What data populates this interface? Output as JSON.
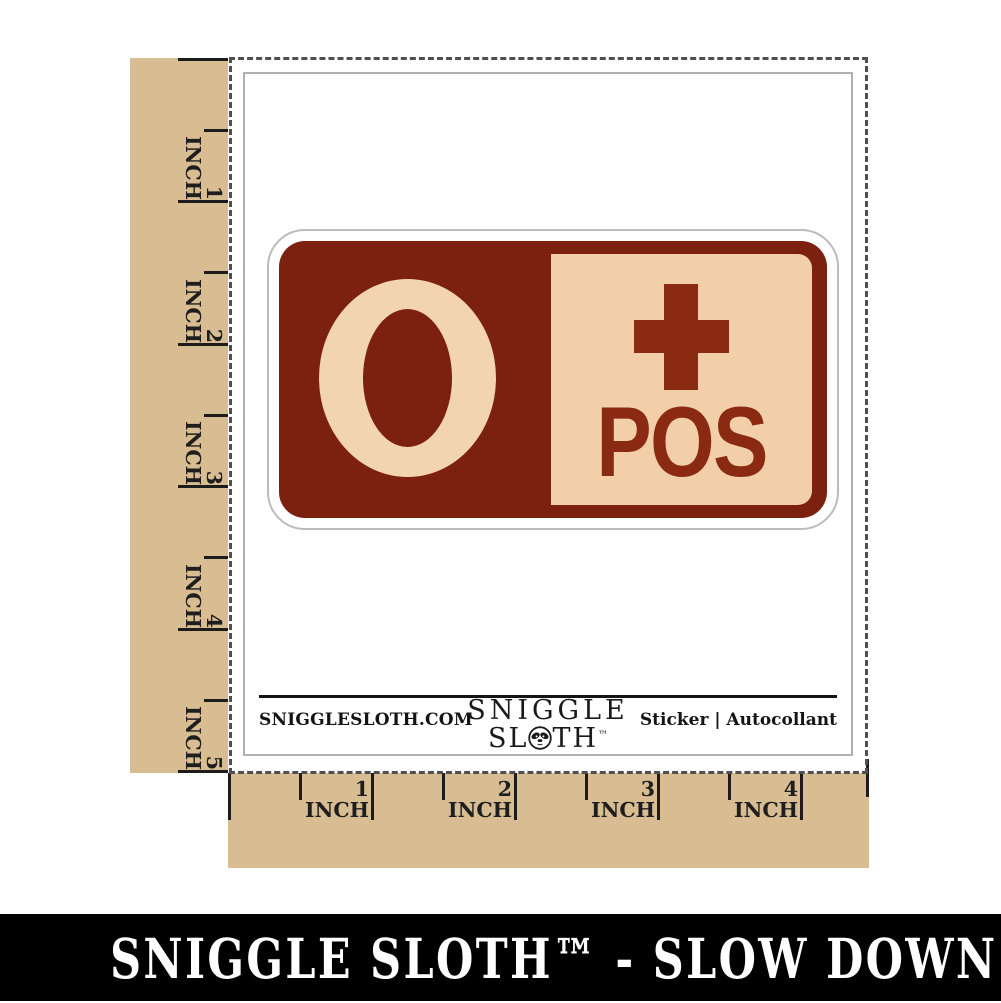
{
  "rulers": {
    "unit": "INCH",
    "vertical_labels": [
      "1",
      "2",
      "3",
      "4",
      "5"
    ],
    "horizontal_labels": [
      "1",
      "2",
      "3",
      "4"
    ]
  },
  "sticker": {
    "blood_type": "O",
    "plus_icon": "plus-cross",
    "rh_label": "POS"
  },
  "sheet_footer": {
    "website": "SNIGGLESLOTH.COM",
    "logo_line1": "SNIGGLE",
    "logo_line2_left": "SL",
    "logo_line2_right": "TH",
    "logo_trademark": "™",
    "product_label": "Sticker | Autocollant"
  },
  "banner": {
    "text": "SNIGGLE SLOTH™ - SLOW DOWN & CRAFT"
  },
  "colors": {
    "ruler_tan": "#d8bc92",
    "sticker_maroon": "#7c2010",
    "sticker_accent_maroon": "#8b2a13",
    "sticker_cream": "#f2cfa9",
    "blood_o_cream": "#f3d4b1",
    "banner_black": "#000000"
  }
}
